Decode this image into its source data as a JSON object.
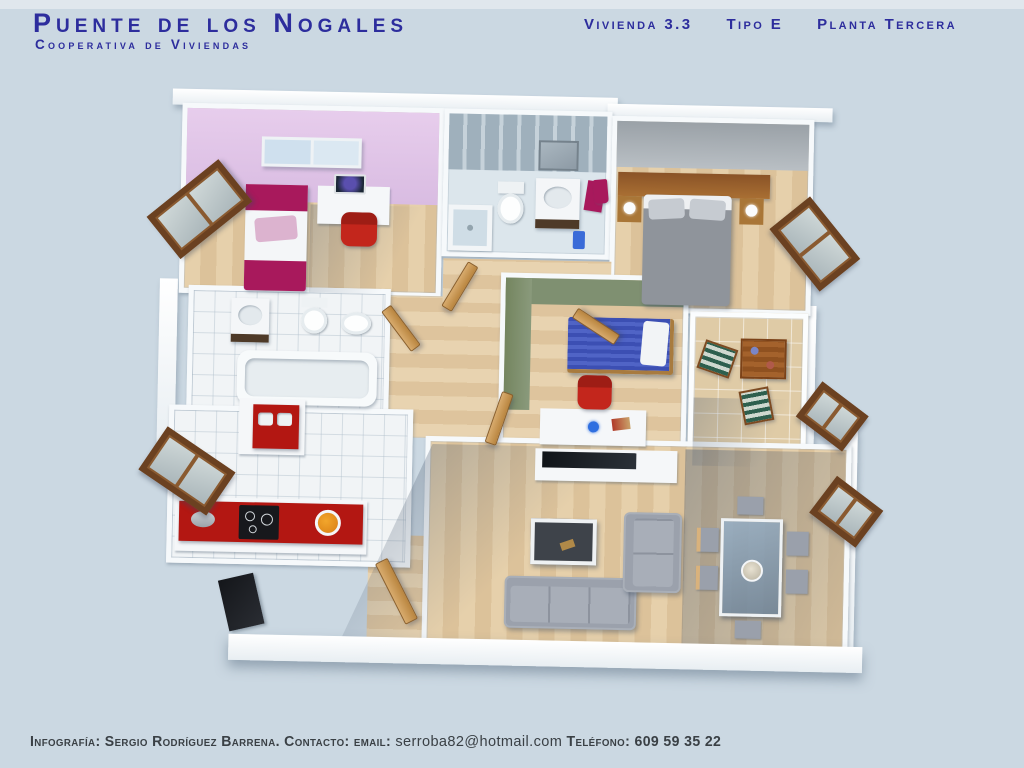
{
  "header": {
    "title": "Puente de los Nogales",
    "subtitle": "Cooperativa de Viviendas",
    "unit": "Vivienda 3.3",
    "type": "Tipo E",
    "floor": "Planta Tercera"
  },
  "footer": {
    "contact_prefix": "Infografía: Sergio Rodríguez Barrena. Contacto: email:",
    "email": "serroba82@hotmail.com",
    "phone_label": "Teléfono:",
    "phone": "609 59 35 22"
  },
  "palette": {
    "bg": "#cbd8e2",
    "title-blue": "#2d2d9d",
    "footer-gray": "#3a4045",
    "wall-white": "#f6f9fb",
    "pink-wall": "#e2c5e8",
    "green-wall": "#7f9071",
    "gray-wall": "#9ba2a8",
    "tile-bath": "#dde7ed",
    "tile-white": "#f1f4f6",
    "terrace-tan": "#dfcba6",
    "counter-red": "#b31712",
    "magenta": "#a8195c",
    "bed-blue": "#4356bb",
    "sofa-gray": "#9ba1ac",
    "chair-red": "#c3261c",
    "frame-brown": "#6b4121",
    "door-wood": "#cfa266"
  }
}
